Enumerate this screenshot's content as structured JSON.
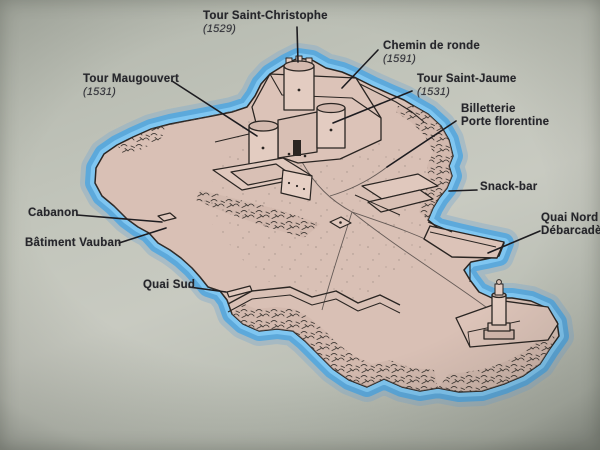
{
  "panel": {
    "description_labels": {
      "tour_saint_christophe": {
        "title": "Tour Saint-Christophe",
        "year": "(1529)"
      },
      "chemin_de_ronde": {
        "title": "Chemin de ronde",
        "year": "(1591)"
      },
      "tour_maugouvert": {
        "title": "Tour Maugouvert",
        "year": "(1531)"
      },
      "tour_saint_jaume": {
        "title": "Tour Saint-Jaume",
        "year": "(1531)"
      },
      "billetterie": {
        "title": "Billetterie",
        "subtitle": "Porte florentine"
      },
      "snack_bar": {
        "title": "Snack-bar"
      },
      "quai_nord": {
        "title": "Quai Nord",
        "subtitle": "Débarcadère"
      },
      "cabanon": {
        "title": "Cabanon"
      },
      "batiment_vauban": {
        "title": "Bâtiment Vauban"
      },
      "quai_sud": {
        "title": "Quai Sud"
      }
    },
    "colors": {
      "background": "#bdc1b7",
      "island_fill": "#d9c0b5",
      "water_halo_inner": "#7fc6f1",
      "water_halo_mid": "#58a8dc",
      "water_halo_outer": "#86aecd",
      "ink": "#2a2522",
      "label_text": "#26262b"
    }
  }
}
